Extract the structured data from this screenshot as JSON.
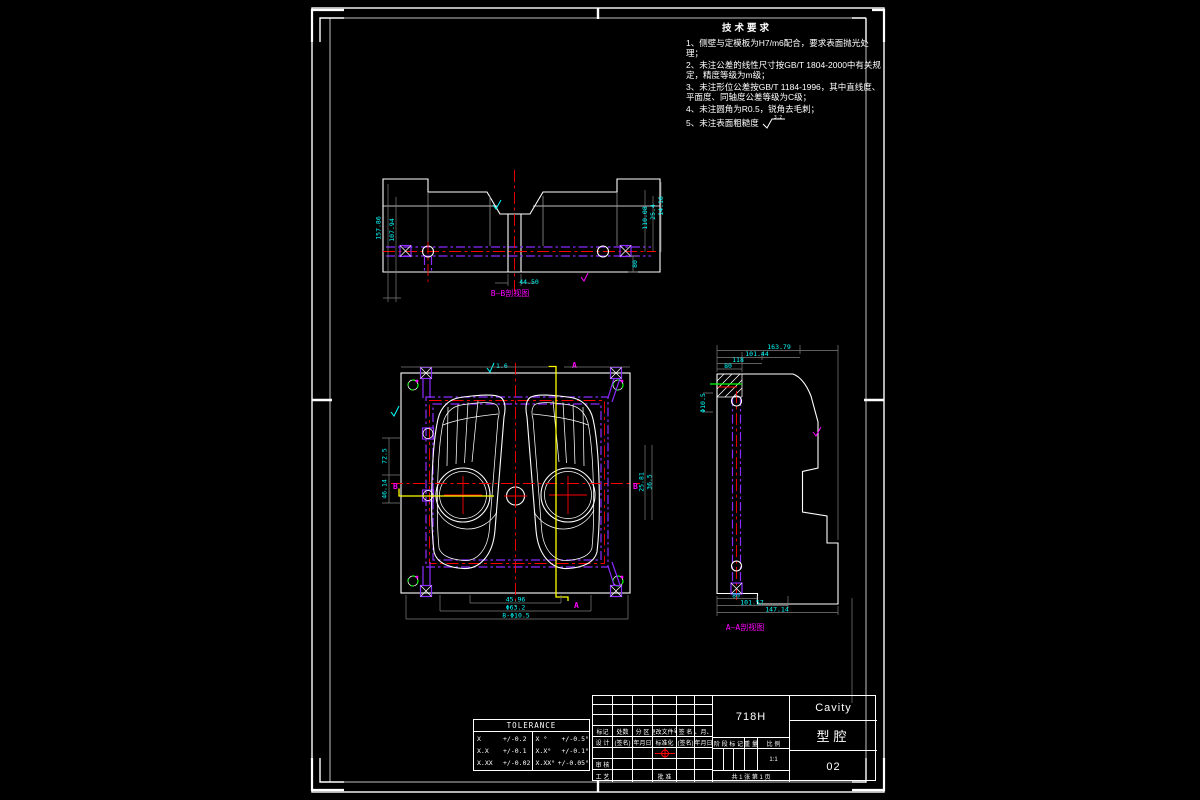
{
  "app": {
    "kind": "CAD engineering drawing",
    "background": "#000000"
  },
  "colors": {
    "outline": "#ffffff",
    "dimension_text": "#00ffff",
    "centerline": "#ff0000",
    "cooling_channel": "#8a2bff",
    "section_line": "#ffff00",
    "view_label": "#ff00ff",
    "hole_mark": "#00ff00",
    "dim_line": "#7e7e7e"
  },
  "tech_requirements": {
    "title": "技术要求",
    "lines": [
      "1、侧壁与定模板为H7/m6配合，要求表面抛光处理；",
      "2、未注公差的线性尺寸按GB/T 1804-2000中有关规定，精度等级为m级；",
      "3、未注形位公差按GB/T 1184-1996，其中直线度、平面度、同轴度公差等级为C级；",
      "4、未注圆角为R0.5，锐角去毛刺；",
      "5、未注表面粗糙度"
    ],
    "roughness_value": "3.2"
  },
  "views": {
    "section": {
      "label": "B—B剖视图",
      "dims": {
        "left_outer": "157.86",
        "left_inner": "107.94",
        "right_a": "110.08",
        "right_b": "25.4",
        "right_c": "14.16",
        "right_d": "80",
        "bottom": "44.50"
      }
    },
    "plan": {
      "marks": {
        "a_top": "A",
        "a_bottom": "A",
        "b_left": "B",
        "b_right": "B"
      },
      "roughness_top": "1.6",
      "dims": {
        "left_upper": "72.5",
        "left_lower": "46.14",
        "bottom_1": "45.96",
        "bottom_2": "Φ63.2",
        "bottom_3": "8-Φ10.5",
        "right_1": "25.81",
        "right_2": "36.5"
      }
    },
    "side": {
      "label": "A—A剖视图",
      "dims": {
        "top_1": "163.79",
        "top_2": "101.44",
        "top_3": "118",
        "top_4": "80",
        "left": "Φ10.5",
        "bottom_1": "80",
        "bottom_2": "101.57",
        "bottom_3": "147.14"
      }
    }
  },
  "tolerance_table": {
    "title": "TOLERANCE",
    "rows": [
      {
        "c0": "X",
        "c1": "+/-0.2",
        "c2": "X °",
        "c3": "+/-0.5°"
      },
      {
        "c0": "X.X",
        "c1": "+/-0.1",
        "c2": "X.X°",
        "c3": "+/-0.1°"
      },
      {
        "c0": "X.XX",
        "c1": "+/-0.02",
        "c2": "X.XX°",
        "c3": "+/-0.05°"
      }
    ]
  },
  "title_block": {
    "material": "718H",
    "part_name_en": "Cavity",
    "part_name_cn": "型腔",
    "drawing_number": "02",
    "revision_headers": [
      "标记",
      "处数",
      "分 区",
      "更改文件号",
      "签 名",
      "年、月、日"
    ],
    "sign_row": [
      "设 计",
      "(签名)",
      "(年月日)",
      "标准化",
      "(签名)",
      "(年月日)"
    ],
    "check_label": "审 核",
    "process_label": "工 艺",
    "approve_label": "批 准",
    "stage_label": "阶 段 标 记",
    "weight_label": "重 量",
    "scale_label": "比 例",
    "scale_value": "1:1",
    "sheet_info": "共 1 张  第 1 页"
  }
}
